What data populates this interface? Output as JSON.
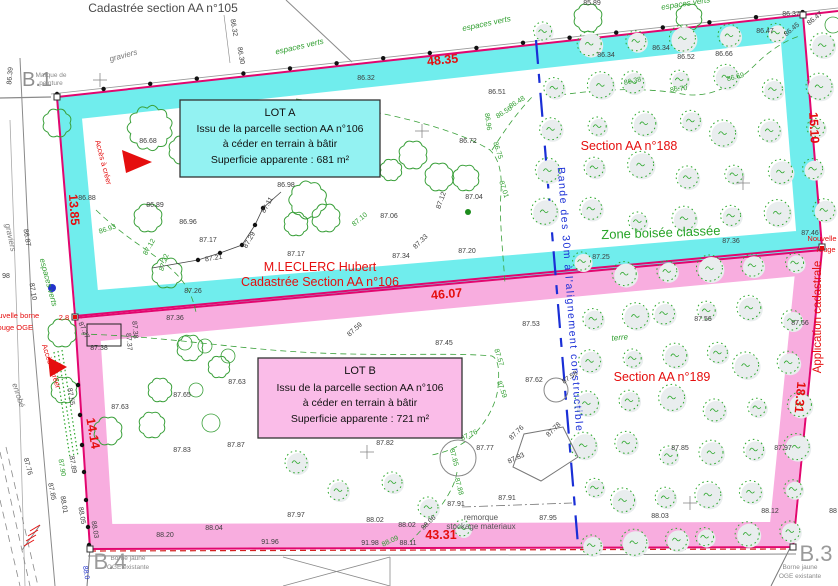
{
  "header": {
    "title": "Cadastrée section AA n°105"
  },
  "lot_a": {
    "lines": [
      "LOT A",
      "Issu de la parcelle section AA n°106",
      "à céder en terrain à bâtir",
      "Superficie apparente : 681 m²"
    ]
  },
  "lot_b": {
    "lines": [
      "LOT B",
      "Issu de la parcelle section AA n°106",
      "à céder en terrain à bâtir",
      "Superficie apparente : 721 m²"
    ]
  },
  "owner": {
    "name": "M.LECLERC Hubert",
    "parcel": "Cadastrée Section AA n°106"
  },
  "sections": {
    "s188": "Section AA n°188",
    "s189": "Section AA n°189",
    "zone": "Zone boisée classée",
    "band": "Bande des 30m à l'alignement constructible",
    "application": "Application cadastrale"
  },
  "dimensions": {
    "top": "48.35",
    "middle": "46.07",
    "bottom": "43.31",
    "west_upper": "13.85",
    "west_lower": "14.14",
    "east_upper": "15.10",
    "east_lower": "18.31"
  },
  "corners": {
    "b1": {
      "label": "B.1",
      "note": "Marque de peinture"
    },
    "b3": {
      "label": "B.3",
      "note": "Borne jaune OGE existante"
    },
    "b4": {
      "label": "B.4",
      "note": "Borne jaune OGE existante"
    }
  },
  "colors": {
    "cyan_band": "#70EDED",
    "pink_band": "#F8ADDF",
    "boundary_magenta": "#E2066F",
    "red_text": "#E50E0E",
    "tree_green": "#2DA82D",
    "limit_blue": "#1A2FD6"
  },
  "labels": [
    [
      "Cadastrée section AA n°105",
      163,
      12,
      0,
      "hdr"
    ],
    [
      "B.1",
      37,
      86,
      0,
      "big"
    ],
    [
      "Marque de",
      51,
      77,
      0,
      "sm",
      "s"
    ],
    [
      "peinture",
      51,
      85,
      0,
      "sm",
      "s"
    ],
    [
      "B.3",
      816,
      561,
      0,
      "big2"
    ],
    [
      "Borne jaune",
      800,
      569,
      0,
      "sm",
      "s"
    ],
    [
      "OGE existante",
      800,
      578,
      0,
      "sm",
      "s"
    ],
    [
      "B.4",
      110,
      569,
      0,
      "big2"
    ],
    [
      "Borne jaune",
      128,
      560,
      0,
      "sm",
      "s"
    ],
    [
      "OGE existante",
      128,
      569,
      0,
      "sm",
      "s"
    ],
    [
      "48.35",
      443,
      64,
      -6,
      "d"
    ],
    [
      "46.07",
      447,
      298,
      -5,
      "d"
    ],
    [
      "43.31",
      441,
      539,
      0,
      "d"
    ],
    [
      "13.85",
      70,
      210,
      86,
      "d"
    ],
    [
      "14.14",
      89,
      434,
      80,
      "d"
    ],
    [
      "15.10",
      810,
      128,
      87,
      "d"
    ],
    [
      "18.31",
      796,
      397,
      95,
      "d"
    ],
    [
      "2.8",
      64,
      320,
      0,
      "rs"
    ],
    [
      "Nouvelle borne",
      14,
      318,
      0,
      "rs",
      "s"
    ],
    [
      "rouge  OGE",
      14,
      330,
      0,
      "rs",
      "s"
    ],
    [
      "Nouvelle",
      822,
      241,
      0,
      "rs",
      "s"
    ],
    [
      "rouge",
      826,
      252,
      0,
      "rs",
      "s"
    ],
    [
      "Accès à créer",
      101,
      163,
      75,
      "rs"
    ],
    [
      "Accès à créer",
      49,
      367,
      72,
      "rs"
    ],
    [
      "Application cadastrale",
      821,
      317,
      -90,
      "ac"
    ],
    [
      "Section AA n°188",
      629,
      150,
      0,
      "rb"
    ],
    [
      "Section AA n°189",
      662,
      381,
      0,
      "rb"
    ],
    [
      "M.LECLERC Hubert",
      320,
      271,
      0,
      "rb"
    ],
    [
      "Cadastrée Section AA n°106",
      320,
      286,
      0,
      "rb"
    ],
    [
      "Zone boisée classée",
      661,
      237,
      -2,
      "gz"
    ],
    [
      "Bande des 30m à l'alignement constructible",
      567,
      300,
      86,
      "bl2"
    ],
    [
      "espaces verts",
      300,
      49,
      -13,
      "gi"
    ],
    [
      "espaces verts",
      487,
      26,
      -12,
      "gi"
    ],
    [
      "espaces verts",
      686,
      6,
      -9,
      "gi"
    ],
    [
      "espaces verts",
      46,
      283,
      75,
      "gi"
    ],
    [
      "terre",
      620,
      340,
      -5,
      "gi"
    ],
    [
      "graviers",
      124,
      58,
      -15,
      "gy"
    ],
    [
      "graviers",
      8,
      238,
      78,
      "gy"
    ],
    [
      "enrobé",
      16,
      396,
      72,
      "gy"
    ],
    [
      "remorque",
      481,
      520,
      0,
      "sm2"
    ],
    [
      "stockage materiaux",
      481,
      529,
      0,
      "sm2"
    ],
    [
      "88.0",
      84,
      573,
      80,
      "bl"
    ],
    [
      "86.39",
      12,
      76,
      -85,
      "e"
    ],
    [
      "86.32",
      232,
      28,
      80,
      "e"
    ],
    [
      "86.30",
      239,
      56,
      80,
      "e"
    ],
    [
      "86.47",
      225,
      127,
      0,
      "e"
    ],
    [
      "86.68",
      148,
      143,
      0,
      "e"
    ],
    [
      "86.32",
      366,
      80,
      0,
      "e"
    ],
    [
      "86.51",
      497,
      94,
      0,
      "e"
    ],
    [
      "86.72",
      468,
      143,
      0,
      "e"
    ],
    [
      "86.98",
      286,
      187,
      0,
      "e"
    ],
    [
      "86.88",
      87,
      200,
      0,
      "e"
    ],
    [
      "86.89",
      155,
      207,
      0,
      "e"
    ],
    [
      "86.96",
      188,
      224,
      0,
      "e"
    ],
    [
      "87.17",
      208,
      242,
      0,
      "e"
    ],
    [
      "87.21",
      214,
      260,
      -10,
      "e"
    ],
    [
      "87.29",
      251,
      241,
      -60,
      "e"
    ],
    [
      "87.11",
      269,
      206,
      -60,
      "e"
    ],
    [
      "87.17",
      296,
      256,
      0,
      "e"
    ],
    [
      "87.06",
      389,
      218,
      0,
      "e"
    ],
    [
      "87.34",
      401,
      258,
      0,
      "e"
    ],
    [
      "87.33",
      422,
      243,
      -45,
      "e"
    ],
    [
      "87.12",
      443,
      201,
      -70,
      "e"
    ],
    [
      "87.20",
      467,
      253,
      0,
      "e"
    ],
    [
      "87.04",
      474,
      199,
      0,
      "e"
    ],
    [
      "85.89",
      592,
      5,
      0,
      "e"
    ],
    [
      "86.34",
      606,
      57,
      0,
      "e"
    ],
    [
      "86.34",
      661,
      50,
      0,
      "e"
    ],
    [
      "86.52",
      686,
      59,
      0,
      "e"
    ],
    [
      "86.66",
      724,
      56,
      0,
      "e"
    ],
    [
      "86.47",
      765,
      33,
      0,
      "e"
    ],
    [
      "86.37",
      791,
      16,
      0,
      "e"
    ],
    [
      "86.45",
      793,
      31,
      -40,
      "e"
    ],
    [
      "86.47",
      816,
      20,
      -40,
      "e"
    ],
    [
      "87.25",
      601,
      259,
      0,
      "e"
    ],
    [
      "87.36",
      731,
      243,
      0,
      "e"
    ],
    [
      "87.46",
      810,
      235,
      0,
      "e"
    ],
    [
      "87.56",
      703,
      321,
      0,
      "e"
    ],
    [
      "87.66",
      800,
      325,
      0,
      "e"
    ],
    [
      "87.26",
      193,
      293,
      0,
      "e"
    ],
    [
      "87.36",
      175,
      320,
      0,
      "e"
    ],
    [
      "87.27",
      82,
      331,
      65,
      "e"
    ],
    [
      "87.38",
      133,
      330,
      85,
      "e"
    ],
    [
      "87.37",
      127,
      342,
      85,
      "e"
    ],
    [
      "87.38",
      99,
      350,
      0,
      "e"
    ],
    [
      "86.87",
      25,
      238,
      80,
      "e"
    ],
    [
      "87.10",
      31,
      292,
      80,
      "e"
    ],
    [
      "98",
      6,
      278,
      0,
      "e"
    ],
    [
      "87.53",
      531,
      326,
      0,
      "e"
    ],
    [
      "87.45",
      444,
      345,
      0,
      "e"
    ],
    [
      "87.59",
      356,
      331,
      -42,
      "e"
    ],
    [
      "87.58",
      571,
      379,
      -35,
      "e"
    ],
    [
      "87.62",
      534,
      382,
      0,
      "e"
    ],
    [
      "87.63",
      120,
      409,
      0,
      "e"
    ],
    [
      "87.65",
      182,
      397,
      0,
      "e"
    ],
    [
      "87.63",
      237,
      384,
      0,
      "e"
    ],
    [
      "87.83",
      182,
      452,
      0,
      "e"
    ],
    [
      "87.87",
      236,
      447,
      0,
      "e"
    ],
    [
      "87.81",
      295,
      432,
      0,
      "e"
    ],
    [
      "87.82",
      385,
      445,
      0,
      "e"
    ],
    [
      "87.77",
      485,
      450,
      0,
      "e"
    ],
    [
      "87.76",
      518,
      434,
      -45,
      "e"
    ],
    [
      "87.78",
      555,
      431,
      -45,
      "e"
    ],
    [
      "87.83",
      517,
      460,
      -25,
      "e"
    ],
    [
      "87.85",
      680,
      450,
      0,
      "e"
    ],
    [
      "87.97",
      783,
      450,
      0,
      "e"
    ],
    [
      "88.12",
      770,
      513,
      0,
      "e"
    ],
    [
      "88.03",
      660,
      518,
      0,
      "e"
    ],
    [
      "87.95",
      548,
      520,
      0,
      "e"
    ],
    [
      "87.91",
      456,
      506,
      0,
      "e"
    ],
    [
      "87.91",
      507,
      500,
      0,
      "e"
    ],
    [
      "88.06",
      430,
      524,
      -45,
      "e"
    ],
    [
      "88.02",
      375,
      522,
      0,
      "e"
    ],
    [
      "88.02",
      407,
      527,
      0,
      "e"
    ],
    [
      "88.11",
      408,
      545,
      0,
      "e"
    ],
    [
      "91.96",
      270,
      544,
      0,
      "e"
    ],
    [
      "91.98",
      370,
      545,
      0,
      "e"
    ],
    [
      "88.04",
      214,
      530,
      0,
      "e"
    ],
    [
      "88.20",
      165,
      537,
      0,
      "e"
    ],
    [
      "87.97",
      296,
      517,
      0,
      "e"
    ],
    [
      "88",
      833,
      513,
      0,
      "e"
    ],
    [
      "87.55",
      69,
      397,
      80,
      "e"
    ],
    [
      "87.89",
      71,
      465,
      80,
      "e"
    ],
    [
      "87.85",
      50,
      492,
      78,
      "e"
    ],
    [
      "88.01",
      62,
      505,
      80,
      "e"
    ],
    [
      "88.05",
      80,
      516,
      80,
      "e"
    ],
    [
      "88.03",
      93,
      530,
      80,
      "e"
    ],
    [
      "87.76",
      26,
      467,
      75,
      "e"
    ],
    [
      "86.48",
      518,
      104,
      -32,
      "g"
    ],
    [
      "86.56",
      505,
      114,
      -32,
      "g"
    ],
    [
      "86.96",
      486,
      122,
      82,
      "g"
    ],
    [
      "86.75",
      496,
      151,
      72,
      "g"
    ],
    [
      "87.01",
      502,
      190,
      72,
      "g"
    ],
    [
      "87.10",
      361,
      221,
      -40,
      "g"
    ],
    [
      "86.93",
      108,
      231,
      -18,
      "g"
    ],
    [
      "87.12",
      151,
      248,
      -60,
      "g"
    ],
    [
      "87.22",
      166,
      263,
      -72,
      "g"
    ],
    [
      "86.38",
      633,
      83,
      -12,
      "g"
    ],
    [
      "86.70",
      679,
      91,
      -8,
      "g"
    ],
    [
      "86.69",
      736,
      79,
      -15,
      "g"
    ],
    [
      "87.57",
      497,
      358,
      72,
      "g"
    ],
    [
      "87.59",
      500,
      390,
      70,
      "g"
    ],
    [
      "87.76",
      470,
      437,
      -25,
      "g"
    ],
    [
      "87.85",
      452,
      458,
      75,
      "g"
    ],
    [
      "87.88",
      457,
      487,
      75,
      "g"
    ],
    [
      "88.09",
      391,
      543,
      -25,
      "g"
    ],
    [
      "87.90",
      60,
      468,
      80,
      "g"
    ]
  ]
}
